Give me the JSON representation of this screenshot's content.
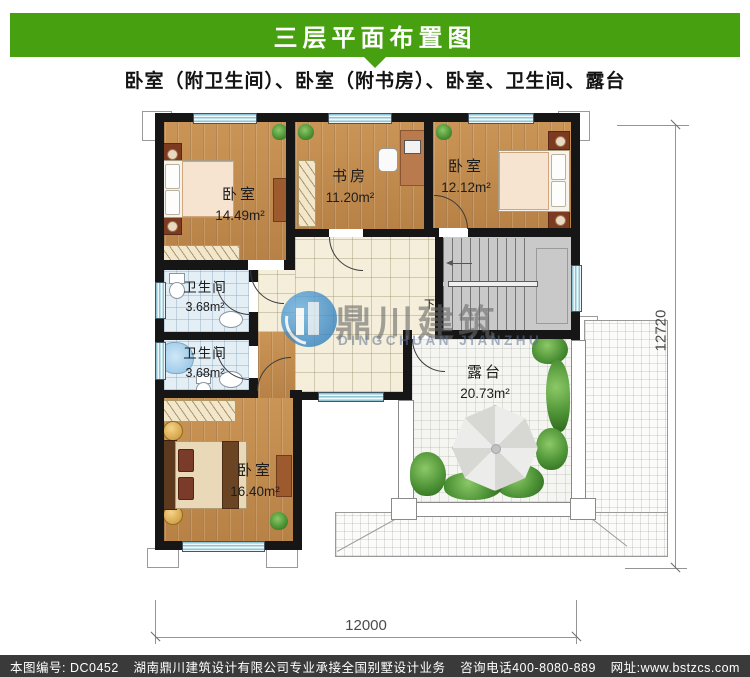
{
  "header": {
    "title": "三层平面布置图",
    "subtitle": "卧室（附卫生间）、卧室（附书房）、卧室、卫生间、露台"
  },
  "rooms": {
    "bedroom_tl": {
      "name": "卧室",
      "area": "14.49m²"
    },
    "study": {
      "name": "书房",
      "area": "11.20m²"
    },
    "bedroom_tr": {
      "name": "卧室",
      "area": "12.12m²"
    },
    "bath1": {
      "name": "卫生间",
      "area": "3.68m²"
    },
    "bath2": {
      "name": "卫生间",
      "area": "3.68m²"
    },
    "bedroom_bl": {
      "name": "卧室",
      "area": "16.40m²"
    },
    "terrace": {
      "name": "露台",
      "area": "20.73m²"
    }
  },
  "stairs": {
    "down_label": "下"
  },
  "dimensions": {
    "bottom": "12000",
    "right": "12720"
  },
  "watermark": {
    "cn": "鼎川建筑",
    "en": "DINGCHUAN JIANZHU"
  },
  "footer": {
    "code": "本图编号: DC0452",
    "company": "湖南鼎川建筑设计有限公司专业承接全国别墅设计业务",
    "phone": "咨询电话400-8080-889",
    "web": "网址:www.bstzcs.com"
  },
  "colors": {
    "banner_green": "#47a00f",
    "footer_gray": "#3a3a3a",
    "wall_black": "#161616",
    "wood": "#c28c4e",
    "hall_tile": "#f4eeda",
    "bath_tile": "#e4eef5",
    "terrace_tile": "#f5f5f2",
    "stair_gray": "#c9c9c9",
    "window_blue": "#8fc3d4",
    "logo_blue": "#1f6fb4"
  }
}
